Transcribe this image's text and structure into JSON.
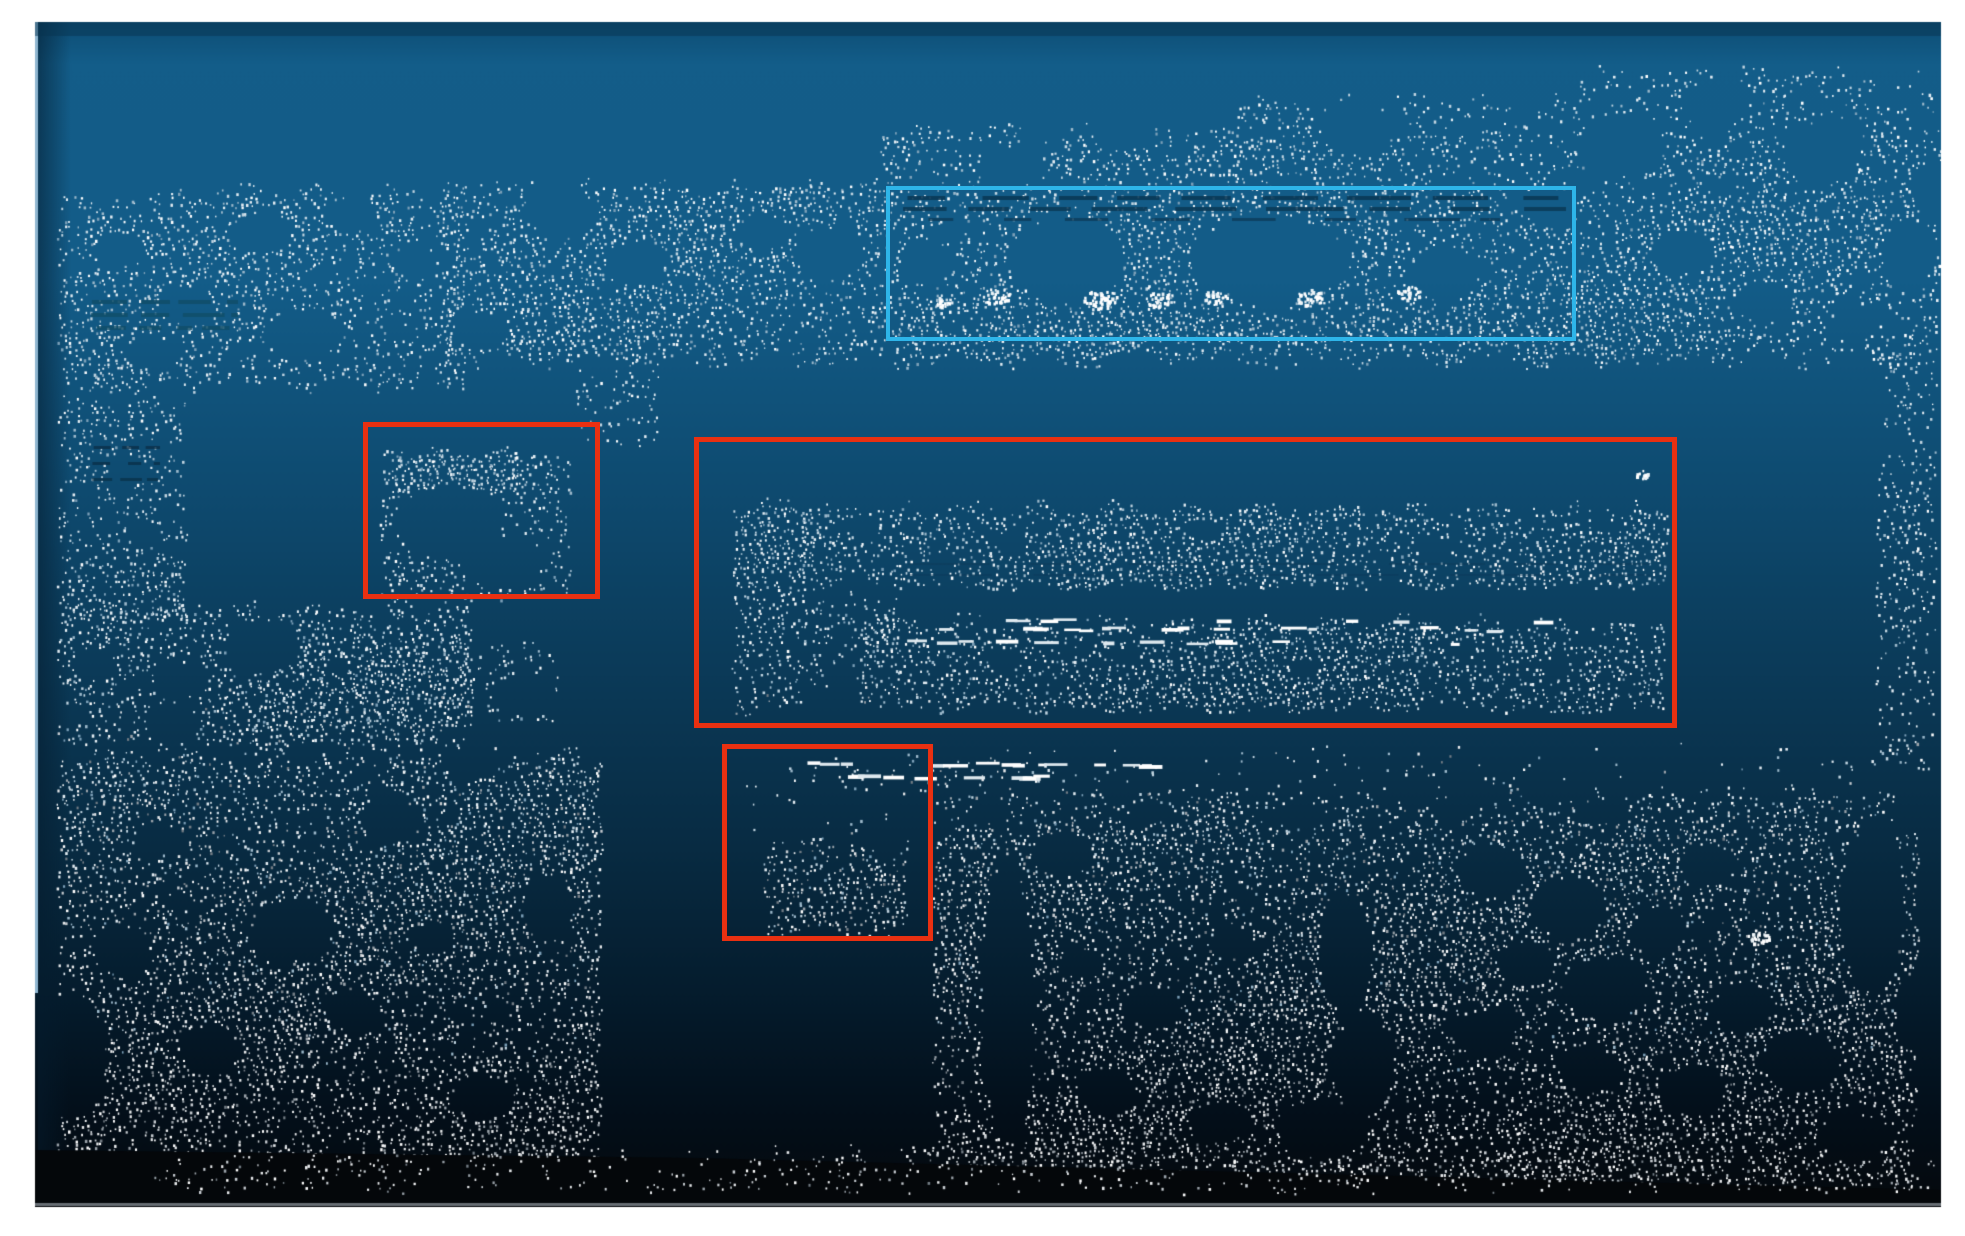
{
  "figure": {
    "kind": "point-cloud-render",
    "page_bg": "#ffffff",
    "accent_cyan": "#2eb5e9",
    "accent_red": "#e93011"
  },
  "annotations": [
    {
      "id": "highlight-box-cyan",
      "x": 886,
      "y": 186,
      "w": 690,
      "h": 155,
      "color": "#2eb5e9",
      "thickness": 4
    },
    {
      "id": "detection-box-red-left",
      "x": 363,
      "y": 422,
      "w": 237,
      "h": 177,
      "color": "#e93011",
      "thickness": 5
    },
    {
      "id": "detection-box-red-large",
      "x": 694,
      "y": 437,
      "w": 983,
      "h": 291,
      "color": "#e93011",
      "thickness": 5
    },
    {
      "id": "detection-box-red-small",
      "x": 722,
      "y": 744,
      "w": 211,
      "h": 197,
      "color": "#e93011",
      "thickness": 5
    }
  ],
  "scene": {
    "content": {
      "x": 35,
      "y": 22,
      "w": 1906,
      "h": 1185
    },
    "grid": 4.6,
    "gradient": [
      [
        0.0,
        "#0d4d74"
      ],
      [
        0.035,
        "#135d89"
      ],
      [
        0.22,
        "#135c88"
      ],
      [
        0.4,
        "#0e4a6f"
      ],
      [
        0.55,
        "#0b3a58"
      ],
      [
        0.7,
        "#082b42"
      ],
      [
        0.82,
        "#051c2d"
      ],
      [
        0.92,
        "#030f1a"
      ],
      [
        1.0,
        "#05090d"
      ]
    ],
    "left_sliver": "#8fb6d0",
    "left_shadow": "rgba(5,28,46,0.55)",
    "top_shade": "rgba(8,52,80,0.5)",
    "palette_blue": [
      "#ffffff",
      "#e4edf3",
      "#c2d5e1",
      "#9db9cb",
      "#7da0b8"
    ],
    "palette_gray": [
      "#ffffff",
      "#e8eaec",
      "#c6cbd0",
      "#9aa2a9",
      "#747d85"
    ],
    "regions": [
      {
        "name": "top-band-left",
        "x0": 60,
        "y0": 184,
        "x1": 462,
        "y1": 394,
        "d": 0.62
      },
      {
        "name": "top-band-main",
        "x0": 445,
        "y0": 178,
        "x1": 1938,
        "y1": 368,
        "d": 0.74,
        "fb": 16
      },
      {
        "name": "top-band-upper-mid",
        "x0": 880,
        "y0": 122,
        "x1": 1938,
        "y1": 186,
        "d": 0.6
      },
      {
        "name": "top-band-upper-right",
        "x0": 1240,
        "y0": 94,
        "x1": 1938,
        "y1": 128,
        "d": 0.5
      },
      {
        "name": "top-band-top-right",
        "x0": 1580,
        "y0": 62,
        "x1": 1920,
        "y1": 98,
        "d": 0.42
      },
      {
        "name": "cyan-hatch-row",
        "x0": 895,
        "y0": 314,
        "x1": 1572,
        "y1": 346,
        "d": 0.5
      },
      {
        "name": "left-column",
        "x0": 60,
        "y0": 392,
        "x1": 188,
        "y1": 628,
        "d": 0.6
      },
      {
        "name": "topband-dip",
        "x0": 578,
        "y0": 362,
        "x1": 660,
        "y1": 448,
        "d": 0.5
      },
      {
        "name": "left-wall-mid",
        "x0": 60,
        "y0": 596,
        "x1": 470,
        "y1": 752,
        "d": 0.7
      },
      {
        "name": "bench",
        "x0": 250,
        "y0": 636,
        "x1": 562,
        "y1": 728,
        "d": 0.45
      },
      {
        "name": "left-wall-lower",
        "x0": 60,
        "y0": 748,
        "x1": 602,
        "y1": 1188,
        "d": 0.78
      },
      {
        "name": "redbox-left-blob",
        "x0": 383,
        "y0": 446,
        "x1": 570,
        "y1": 602,
        "d": 0.55
      },
      {
        "name": "redbox-left-blob-top",
        "x0": 390,
        "y0": 446,
        "x1": 522,
        "y1": 500,
        "d": 0.8
      },
      {
        "name": "shelf-left-block",
        "x0": 735,
        "y0": 498,
        "x1": 808,
        "y1": 716,
        "d": 0.8
      },
      {
        "name": "shelf-upper-band",
        "x0": 800,
        "y0": 500,
        "x1": 1666,
        "y1": 592,
        "d": 0.85
      },
      {
        "name": "shelf-fringe-1",
        "x0": 806,
        "y0": 590,
        "x1": 862,
        "y1": 694,
        "d": 0.5,
        "fb": 26
      },
      {
        "name": "shelf-fringe-2",
        "x0": 866,
        "y0": 590,
        "x1": 902,
        "y1": 652,
        "d": 0.42,
        "fb": 20
      },
      {
        "name": "shelf-lower-band",
        "x0": 862,
        "y0": 614,
        "x1": 1666,
        "y1": 714,
        "d": 0.85
      },
      {
        "name": "right-edge-strip",
        "x0": 1878,
        "y0": 344,
        "x1": 1936,
        "y1": 772,
        "d": 0.5
      },
      {
        "name": "dash-row-speckle",
        "x0": 790,
        "y0": 752,
        "x1": 1180,
        "y1": 798,
        "d": 0.13
      },
      {
        "name": "mid-sparse",
        "x0": 940,
        "y0": 742,
        "x1": 1880,
        "y1": 796,
        "d": 0.1
      },
      {
        "name": "bottom-right-fringe",
        "x0": 935,
        "y0": 788,
        "x1": 1892,
        "y1": 834,
        "d": 0.55
      },
      {
        "name": "bottom-right",
        "x0": 935,
        "y0": 820,
        "x1": 1918,
        "y1": 1192,
        "d": 0.8
      },
      {
        "name": "smallbox-blob",
        "x0": 766,
        "y0": 814,
        "x1": 906,
        "y1": 938,
        "d": 0.75,
        "ft": 22
      },
      {
        "name": "smallbox-sparse",
        "x0": 742,
        "y0": 768,
        "x1": 800,
        "y1": 836,
        "d": 0.12
      },
      {
        "name": "bottom-band",
        "x0": 150,
        "y0": 1146,
        "x1": 1932,
        "y1": 1196,
        "d": 0.32,
        "layer": "bottom"
      }
    ],
    "holes": [
      [
        560,
        212,
        36,
        26
      ],
      [
        634,
        262,
        30,
        22
      ],
      [
        705,
        170,
        32,
        24
      ],
      [
        762,
        232,
        26,
        18
      ],
      [
        830,
        252,
        34,
        26
      ],
      [
        925,
        262,
        26,
        22
      ],
      [
        1065,
        260,
        58,
        44
      ],
      [
        1268,
        258,
        78,
        46
      ],
      [
        1444,
        272,
        34,
        26
      ],
      [
        1010,
        166,
        30,
        20
      ],
      [
        1122,
        130,
        26,
        18
      ],
      [
        1355,
        126,
        38,
        28
      ],
      [
        1620,
        146,
        44,
        32
      ],
      [
        1716,
        102,
        32,
        26
      ],
      [
        1820,
        152,
        40,
        30
      ],
      [
        1890,
        70,
        24,
        16
      ],
      [
        1908,
        252,
        24,
        34
      ],
      [
        1552,
        206,
        26,
        18
      ],
      [
        480,
        330,
        28,
        18
      ],
      [
        1682,
        252,
        30,
        22
      ],
      [
        1762,
        300,
        26,
        20
      ],
      [
        1852,
        322,
        24,
        18
      ],
      [
        1930,
        192,
        16,
        28
      ],
      [
        120,
        248,
        24,
        16
      ],
      [
        186,
        306,
        28,
        18
      ],
      [
        262,
        232,
        30,
        20
      ],
      [
        350,
        212,
        26,
        16
      ],
      [
        415,
        262,
        22,
        16
      ],
      [
        302,
        332,
        38,
        22
      ],
      [
        152,
        352,
        28,
        16
      ],
      [
        126,
        470,
        20,
        14
      ],
      [
        142,
        532,
        18,
        12
      ],
      [
        182,
        680,
        24,
        16
      ],
      [
        92,
        662,
        20,
        14
      ],
      [
        262,
        646,
        38,
        28
      ],
      [
        172,
        722,
        26,
        20
      ],
      [
        122,
        950,
        28,
        24
      ],
      [
        292,
        930,
        42,
        32
      ],
      [
        208,
        1048,
        30,
        24
      ],
      [
        390,
        820,
        30,
        22
      ],
      [
        472,
        762,
        26,
        18
      ],
      [
        352,
        1010,
        26,
        20
      ],
      [
        482,
        1096,
        30,
        22
      ],
      [
        546,
        906,
        24,
        30
      ],
      [
        432,
        936,
        22,
        16
      ],
      [
        156,
        838,
        22,
        16
      ],
      [
        522,
        692,
        28,
        18
      ],
      [
        65,
        1055,
        42,
        62
      ],
      [
        862,
        526,
        16,
        12
      ],
      [
        1012,
        540,
        14,
        10
      ],
      [
        1205,
        530,
        16,
        10
      ],
      [
        1432,
        546,
        14,
        10
      ],
      [
        1600,
        521,
        12,
        9
      ],
      [
        942,
        561,
        12,
        8
      ],
      [
        1002,
        660,
        16,
        12
      ],
      [
        1126,
        656,
        12,
        9
      ],
      [
        1302,
        668,
        14,
        10
      ],
      [
        1462,
        650,
        12,
        9
      ],
      [
        448,
        522,
        55,
        38
      ],
      [
        505,
        562,
        38,
        26
      ],
      [
        792,
        822,
        30,
        18
      ],
      [
        882,
        836,
        26,
        16
      ],
      [
        1007,
        1000,
        26,
        148
      ],
      [
        1062,
        852,
        30,
        22
      ],
      [
        1150,
        1006,
        26,
        20
      ],
      [
        1232,
        942,
        22,
        16
      ],
      [
        1108,
        1092,
        28,
        22
      ],
      [
        1218,
        1122,
        30,
        20
      ],
      [
        1076,
        962,
        18,
        14
      ],
      [
        1345,
        952,
        26,
        60
      ],
      [
        1362,
        1062,
        30,
        52
      ],
      [
        1322,
        1128,
        46,
        28
      ],
      [
        1492,
        872,
        34,
        26
      ],
      [
        1566,
        906,
        38,
        30
      ],
      [
        1524,
        962,
        28,
        22
      ],
      [
        1604,
        988,
        42,
        30
      ],
      [
        1484,
        1032,
        30,
        24
      ],
      [
        1590,
        1068,
        32,
        22
      ],
      [
        1656,
        932,
        28,
        20
      ],
      [
        1706,
        864,
        26,
        20
      ],
      [
        1742,
        1006,
        30,
        24
      ],
      [
        1690,
        1090,
        34,
        24
      ],
      [
        1872,
        906,
        32,
        88
      ],
      [
        1800,
        1060,
        40,
        30
      ],
      [
        1852,
        1136,
        36,
        22
      ],
      [
        1914,
        1012,
        18,
        38
      ],
      [
        990,
        810,
        20,
        12
      ],
      [
        1300,
        812,
        26,
        12
      ],
      [
        1600,
        812,
        30,
        12
      ],
      [
        1450,
        808,
        20,
        10
      ],
      [
        1152,
        810,
        22,
        10
      ]
    ],
    "dark_dashes": [
      {
        "x0": 902,
        "x1": 1566,
        "y": 196,
        "h": 4,
        "seg": 46,
        "gap": 26,
        "c": "rgba(10,56,86,0.9)"
      },
      {
        "x0": 902,
        "x1": 1566,
        "y": 207,
        "h": 4,
        "seg": 58,
        "gap": 30,
        "c": "rgba(10,56,86,0.85)"
      },
      {
        "x0": 920,
        "x1": 1500,
        "y": 218,
        "h": 3,
        "seg": 40,
        "gap": 34,
        "c": "rgba(12,60,90,0.8)"
      },
      {
        "x0": 90,
        "x1": 238,
        "y": 300,
        "h": 4,
        "seg": 26,
        "gap": 12,
        "c": "rgba(16,78,104,0.85)"
      },
      {
        "x0": 90,
        "x1": 238,
        "y": 313,
        "h": 4,
        "seg": 30,
        "gap": 10,
        "c": "rgba(16,78,104,0.8)"
      },
      {
        "x0": 90,
        "x1": 232,
        "y": 326,
        "h": 4,
        "seg": 24,
        "gap": 12,
        "c": "rgba(16,78,104,0.8)"
      },
      {
        "x0": 92,
        "x1": 160,
        "y": 446,
        "h": 3,
        "seg": 18,
        "gap": 10,
        "c": "rgba(10,48,72,0.8)"
      },
      {
        "x0": 92,
        "x1": 160,
        "y": 462,
        "h": 3,
        "seg": 16,
        "gap": 12,
        "c": "rgba(10,48,72,0.8)"
      },
      {
        "x0": 92,
        "x1": 158,
        "y": 478,
        "h": 3,
        "seg": 18,
        "gap": 10,
        "c": "rgba(10,48,72,0.75)"
      },
      {
        "x0": 900,
        "x1": 1650,
        "y": 563,
        "h": 2,
        "seg": 70,
        "gap": 40,
        "c": "rgba(12,58,88,0.5)"
      },
      {
        "x0": 900,
        "x1": 1650,
        "y": 574,
        "h": 2,
        "seg": 90,
        "gap": 50,
        "c": "rgba(12,58,88,0.45)"
      }
    ],
    "bright_dashes": [
      {
        "x0": 798,
        "x1": 1172,
        "y": 763,
        "n": 14
      },
      {
        "x0": 820,
        "x1": 1160,
        "y": 776,
        "n": 10
      },
      {
        "x0": 886,
        "x1": 1556,
        "y": 628,
        "n": 16
      },
      {
        "x0": 900,
        "x1": 1540,
        "y": 641,
        "n": 12
      },
      {
        "x0": 1000,
        "x1": 1560,
        "y": 620,
        "n": 8
      }
    ],
    "bright_clusters": [
      [
        996,
        296,
        14,
        34
      ],
      [
        1100,
        298,
        17,
        46
      ],
      [
        1158,
        299,
        13,
        30
      ],
      [
        1215,
        296,
        12,
        26
      ],
      [
        1310,
        297,
        14,
        32
      ],
      [
        1408,
        292,
        12,
        26
      ],
      [
        942,
        301,
        8,
        16
      ],
      [
        1757,
        938,
        12,
        26
      ],
      [
        1641,
        474,
        7,
        12
      ]
    ],
    "black_band": [
      [
        35,
        1150
      ],
      [
        700,
        1158
      ],
      [
        1400,
        1176
      ],
      [
        1941,
        1190
      ],
      [
        1941,
        1207
      ],
      [
        35,
        1207
      ]
    ],
    "black_band_color": "#04070a",
    "bottom_rule": {
      "y": 1203,
      "h": 3,
      "c": "#676d73"
    }
  }
}
